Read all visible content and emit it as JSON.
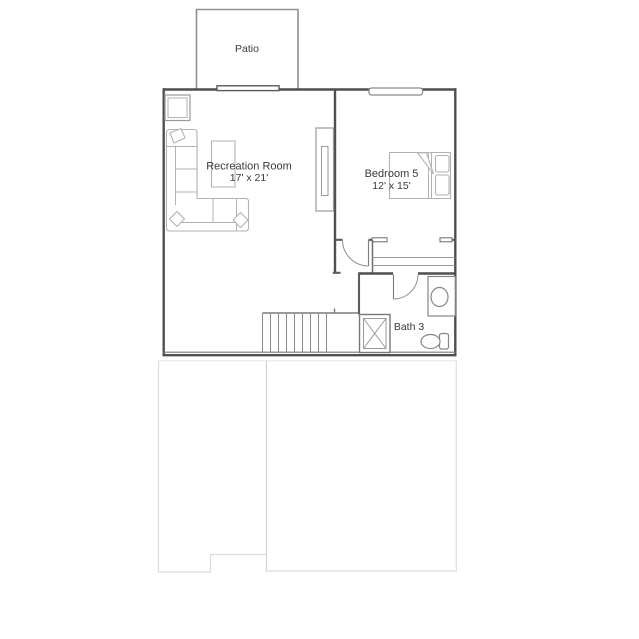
{
  "colors": {
    "wall": "#4f4f4f",
    "wall_light": "#8f8f8f",
    "furniture": "#b2b2b2",
    "fixture": "#868686",
    "lower_level": "#dcdcdc",
    "text": "#3a3a3a",
    "background": "#ffffff"
  },
  "floor_plan": {
    "patio": {
      "label": "Patio"
    },
    "recreation_room": {
      "label": "Recreation Room",
      "dimensions": "17' x 21'"
    },
    "bedroom_5": {
      "label": "Bedroom 5",
      "dimensions": "12' x 15'"
    },
    "bath_3": {
      "label": "Bath 3"
    },
    "features": [
      "sectional-sofa",
      "coffee-table",
      "end-table",
      "media-console",
      "bed",
      "closet-shelves",
      "stairs",
      "shower",
      "vanity-sink",
      "toilet",
      "patio-door-threshold",
      "bedroom-window",
      "bedroom-door",
      "bath-door",
      "lower-level-outline"
    ]
  }
}
